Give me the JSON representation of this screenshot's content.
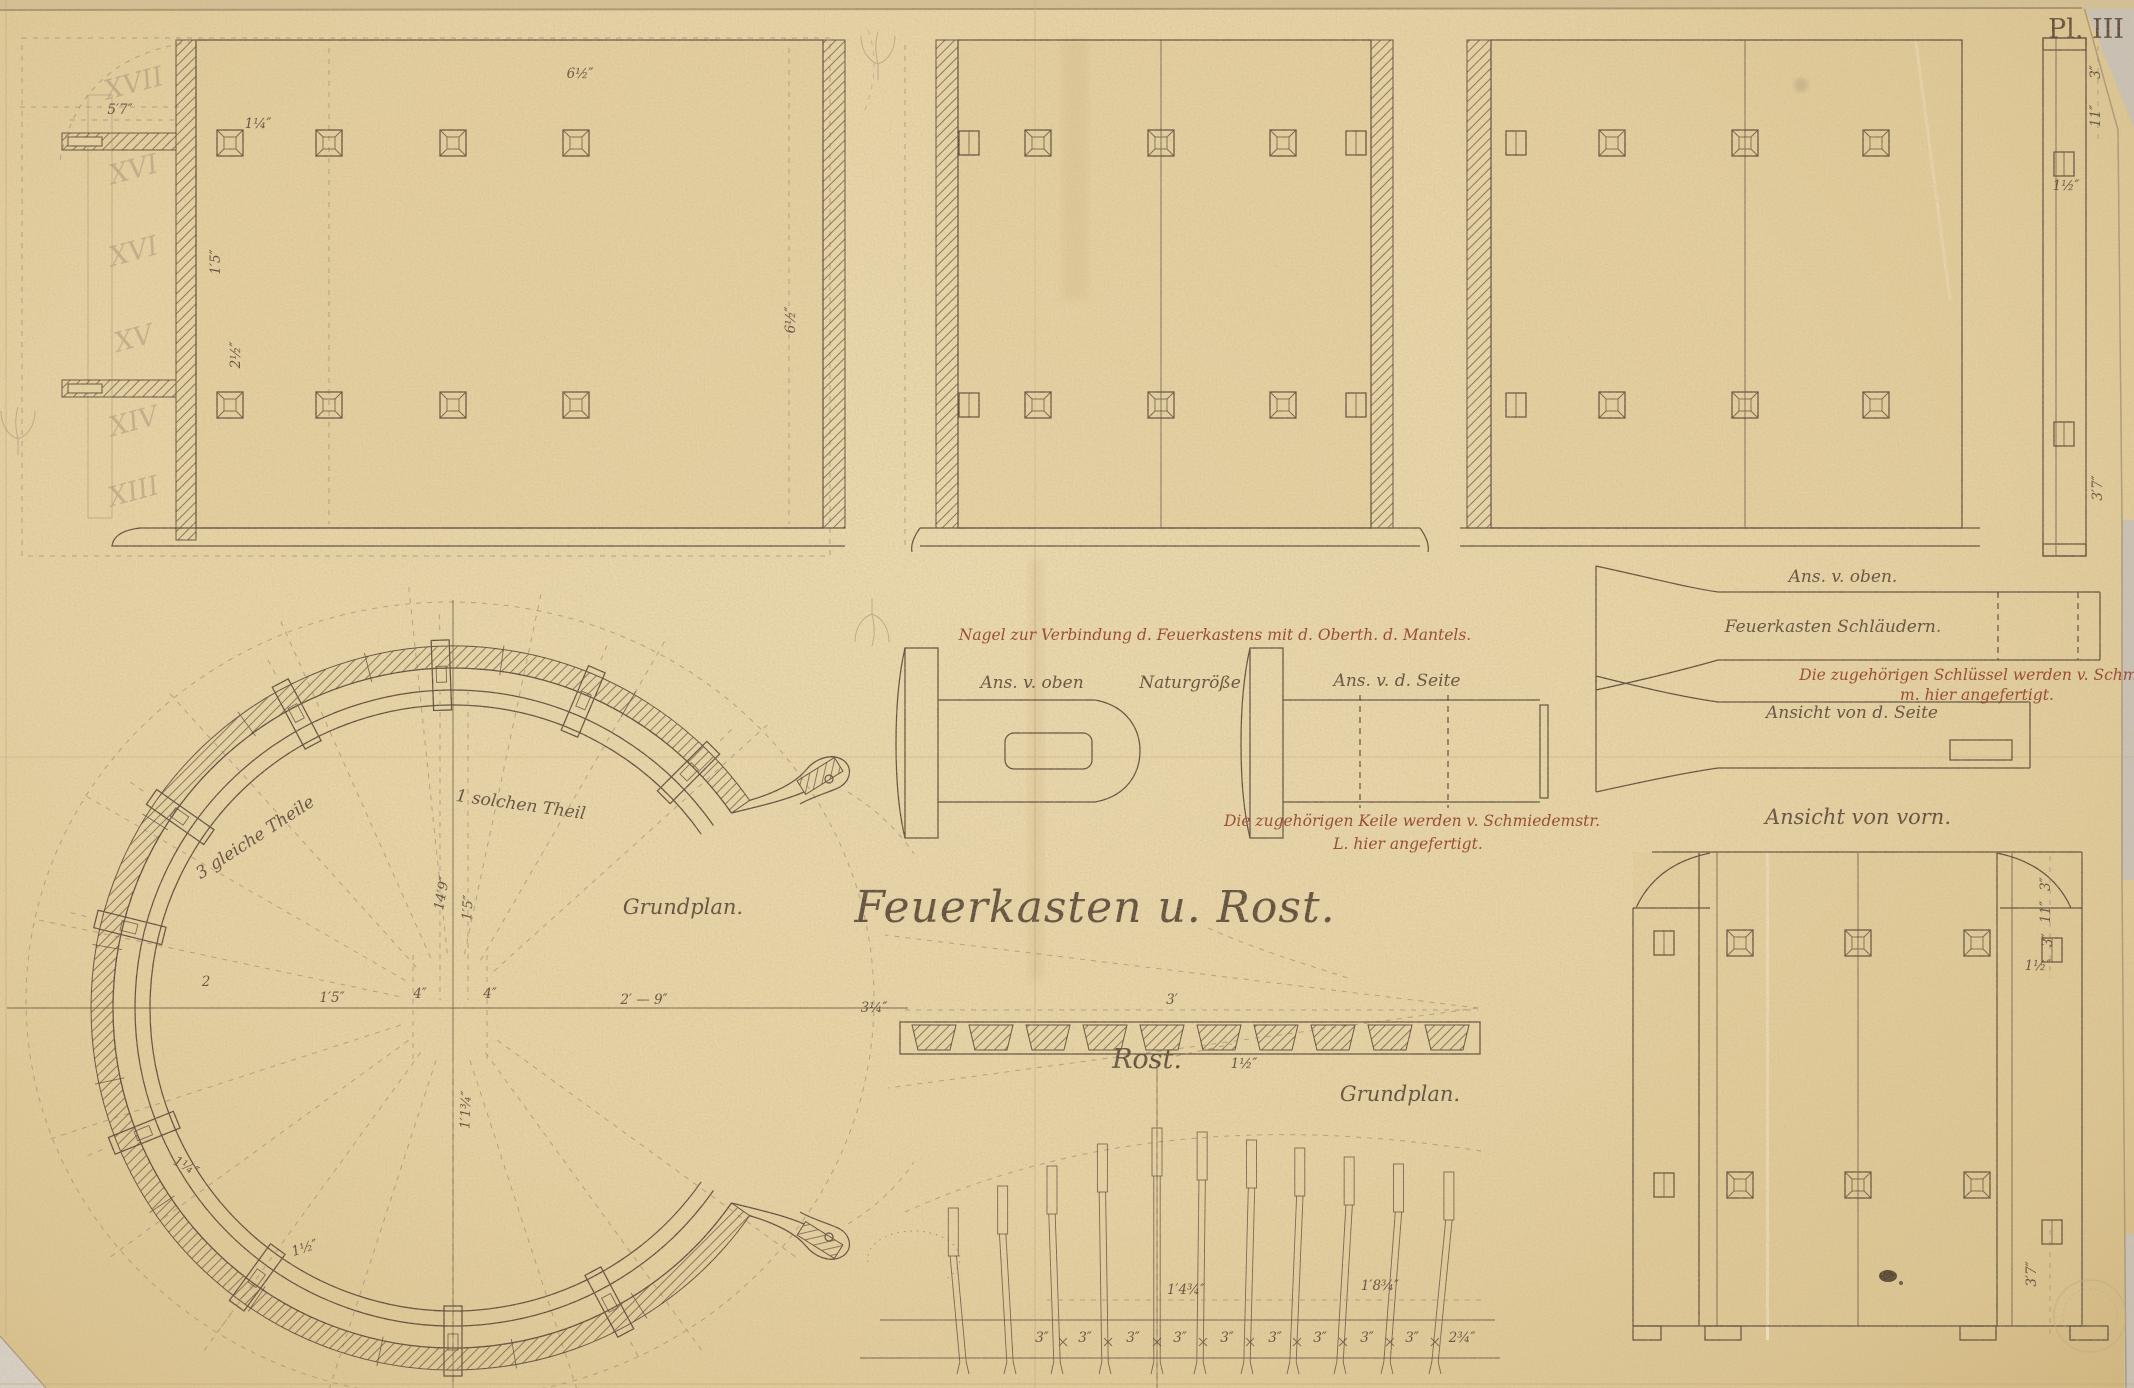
{
  "plate_number": "Pl. III",
  "title": "Feuerkasten u. Rost.",
  "labels": {
    "grundplan_left": "Grundplan.",
    "rost": "Rost.",
    "grundplan_center": "Grundplan.",
    "ring_div_left": "3 gleiche Theile",
    "ring_div_right": "1 solchen Theil",
    "nail_note": "Nagel zur Verbindung d. Feuerkastens mit d. Oberth. d. Mantels.",
    "nail_view_top": "Ans. v. oben",
    "nail_scale": "Naturgröße",
    "nail_view_side": "Ans. v. d. Seite",
    "keile_note_1": "Die zugehörigen Keile werden v. Schmiedemstr.",
    "keile_note_2": "L. hier angefertigt.",
    "stays_view_top": "Ans. v. oben.",
    "stays_title": "Feuerkasten Schläudern.",
    "stays_note_1": "Die zugehörigen Schlüssel werden v. Schmieden",
    "stays_note_2": "m. hier angefertigt.",
    "stays_view_side": "Ansicht von d. Seite",
    "front_view": "Ansicht von vorn."
  },
  "roman_numerals": [
    "XVII",
    "XVI",
    "XVI",
    "XV",
    "XIV",
    "XIII"
  ],
  "dimensions": [
    {
      "t": "5′7″",
      "x": 120,
      "y": 114,
      "r": 0
    },
    {
      "t": "1¼″",
      "x": 258,
      "y": 128,
      "r": 0
    },
    {
      "t": "1′5″",
      "x": 220,
      "y": 262,
      "r": -90
    },
    {
      "t": "2½″",
      "x": 240,
      "y": 355,
      "r": -90
    },
    {
      "t": "6½″",
      "x": 580,
      "y": 78,
      "r": 0
    },
    {
      "t": "6½″",
      "x": 795,
      "y": 320,
      "r": -90
    },
    {
      "t": "3″",
      "x": 2100,
      "y": 72,
      "r": -90
    },
    {
      "t": "11″",
      "x": 2100,
      "y": 116,
      "r": -90
    },
    {
      "t": "1½″",
      "x": 2066,
      "y": 190,
      "r": 0
    },
    {
      "t": "3′7″",
      "x": 2102,
      "y": 488,
      "r": -90
    },
    {
      "t": "14′9″",
      "x": 446,
      "y": 894,
      "r": -80
    },
    {
      "t": "1′5″",
      "x": 472,
      "y": 908,
      "r": -86
    },
    {
      "t": "1′1¾″",
      "x": 470,
      "y": 1110,
      "r": -88
    },
    {
      "t": "2",
      "x": 206,
      "y": 986,
      "r": 0
    },
    {
      "t": "1′5″",
      "x": 332,
      "y": 1002,
      "r": 0
    },
    {
      "t": "4″",
      "x": 420,
      "y": 998,
      "r": 0
    },
    {
      "t": "4″",
      "x": 490,
      "y": 998,
      "r": 0
    },
    {
      "t": "2′ — 9″",
      "x": 644,
      "y": 1004,
      "r": 0
    },
    {
      "t": "1¼″",
      "x": 184,
      "y": 1170,
      "r": 28
    },
    {
      "t": "1½″",
      "x": 306,
      "y": 1252,
      "r": -18
    },
    {
      "t": "3¼″",
      "x": 874,
      "y": 1012,
      "r": 0
    },
    {
      "t": "3′",
      "x": 1172,
      "y": 1004,
      "r": 0
    },
    {
      "t": "1½″",
      "x": 1244,
      "y": 1068,
      "r": 0
    },
    {
      "t": "1′4¾″",
      "x": 1186,
      "y": 1294,
      "r": 0
    },
    {
      "t": "1′8¾″",
      "x": 1380,
      "y": 1290,
      "r": 0
    },
    {
      "t": "3″",
      "x": 1042,
      "y": 1342,
      "r": 0
    },
    {
      "t": "3″",
      "x": 1085,
      "y": 1342,
      "r": 0
    },
    {
      "t": "3″",
      "x": 1133,
      "y": 1342,
      "r": 0
    },
    {
      "t": "3″",
      "x": 1180,
      "y": 1342,
      "r": 0
    },
    {
      "t": "3″",
      "x": 1227,
      "y": 1342,
      "r": 0
    },
    {
      "t": "3″",
      "x": 1275,
      "y": 1342,
      "r": 0
    },
    {
      "t": "3″",
      "x": 1320,
      "y": 1342,
      "r": 0
    },
    {
      "t": "3″",
      "x": 1367,
      "y": 1342,
      "r": 0
    },
    {
      "t": "3″",
      "x": 1412,
      "y": 1342,
      "r": 0
    },
    {
      "t": "2¾″",
      "x": 1462,
      "y": 1342,
      "r": 0
    },
    {
      "t": "3″",
      "x": 2050,
      "y": 884,
      "r": -90
    },
    {
      "t": "11″",
      "x": 2050,
      "y": 912,
      "r": -90
    },
    {
      "t": "3″",
      "x": 2052,
      "y": 940,
      "r": -90
    },
    {
      "t": "1½″",
      "x": 2038,
      "y": 970,
      "r": 0
    },
    {
      "t": "3′7″",
      "x": 2036,
      "y": 1274,
      "r": -90
    }
  ],
  "colors": {
    "paper": "#e8d7a8",
    "ink": "#544738",
    "red_ink": "#8e3b27",
    "pencil": "#9c8c74"
  }
}
